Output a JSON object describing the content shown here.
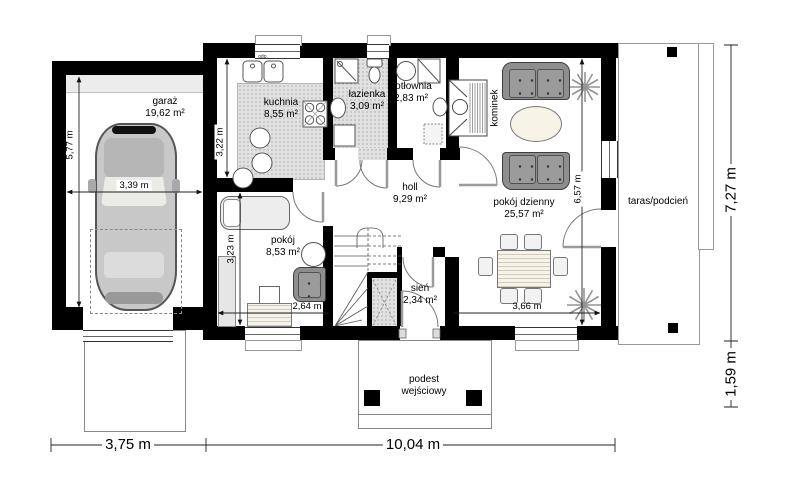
{
  "rooms": {
    "garage": {
      "label": "garaż",
      "area": "19,62 m²"
    },
    "kitchen": {
      "label": "kuchnia",
      "area": "8,55 m²"
    },
    "bathroom": {
      "label": "łazienka",
      "area": "3,09 m²"
    },
    "boiler_room": {
      "label": "kotłownia",
      "area": "2,83 m²"
    },
    "fireplace": {
      "label": "kominek"
    },
    "hall": {
      "label": "holl",
      "area": "9,29 m²"
    },
    "living_room": {
      "label": "pokój dzienny",
      "area": "25,57 m²"
    },
    "room": {
      "label": "pokój",
      "area": "8,53 m²"
    },
    "vestibule": {
      "label": "sień",
      "area": "2,34 m²"
    },
    "entrance_platform": {
      "label_line1": "podest",
      "label_line2": "wejściowy"
    },
    "terrace": {
      "label": "taras/podcień"
    }
  },
  "dimensions": {
    "garage_depth": "5,77 m",
    "garage_width": "3,39 m",
    "kitchen_depth": "3,22 m",
    "room_depth": "3,23 m",
    "room_width": "2,64 m",
    "living_room_depth": "6,57 m",
    "living_room_width": "3,66 m",
    "house_depth_total": "7,27 m",
    "terrace_depth": "1,59 m",
    "garage_bay_width": "3,75 m",
    "house_width": "10,04 m"
  },
  "annotations": {
    "sink_drain": "odp."
  },
  "colors": {
    "walls": "#000000",
    "upholstery": "#8e8e8e",
    "floor_dots": "#e1e1e1"
  }
}
